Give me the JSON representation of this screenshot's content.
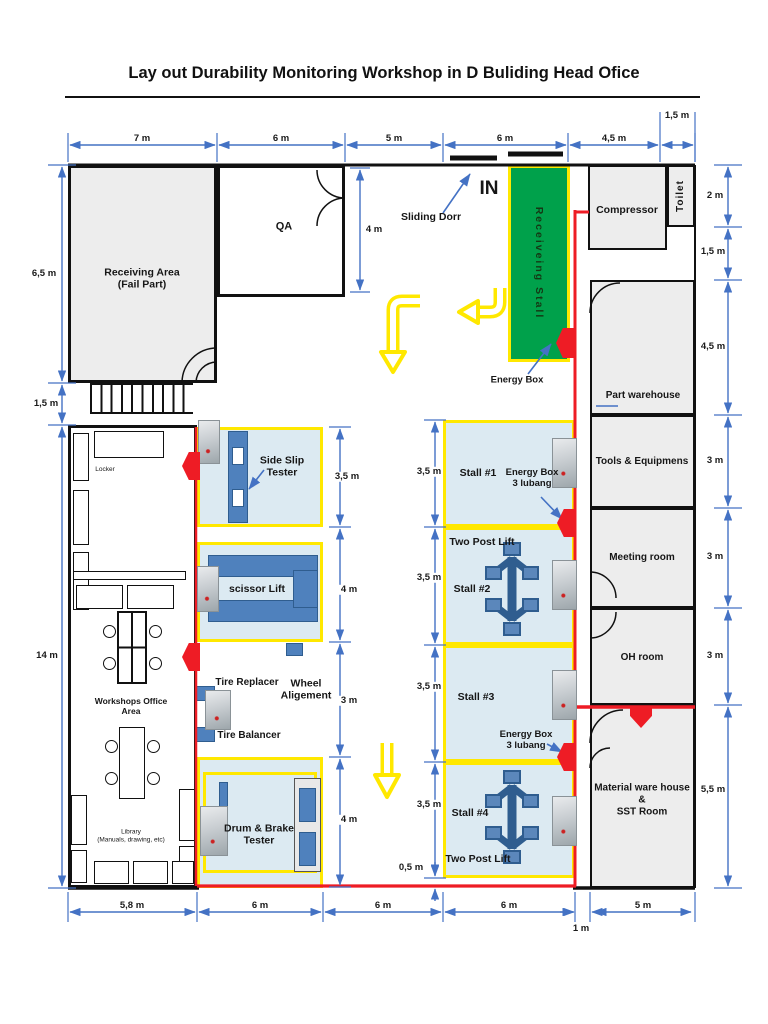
{
  "title": "Lay out Durability Monitoring Workshop in D Buliding Head Ofice",
  "colors": {
    "wall": "#111111",
    "dim-blue": "#4472C4",
    "accent-red": "#EE1C25",
    "accent-yellow": "#FFE800",
    "accent-green": "#00A14B",
    "equip-blue": "#4F81BD",
    "room-fill": "#EDEDED",
    "stall-fill": "#DCEAF2"
  },
  "rooms": {
    "receiving_area": "Receiving Area\n(Fail Part)",
    "qa": "QA",
    "receiving_stall": "Receiveing Stall",
    "compressor": "Compressor",
    "toilet": "Toilet",
    "part_warehouse": "Part warehouse",
    "tools_equipment": "Tools & Equipmens",
    "meeting_room": "Meeting room",
    "oh_room": "OH room",
    "material_sst": "Material ware house\n&\nSST Room"
  },
  "office": {
    "locker": "Locker",
    "workshops_office": "Workshops Office\nArea",
    "library": "Library\n(Manuals, drawing, etc)"
  },
  "equipment": {
    "side_slip_tester": "Side Slip\nTester",
    "scissor_lift": "scissor Lift",
    "tire_replacer": "Tire Replacer",
    "tire_balancer": "Tire Balancer",
    "wheel_alignment": "Wheel\nAligement",
    "drum_brake_tester": "Drum & Brake\nTester"
  },
  "stalls": {
    "stall1": "Stall #1",
    "stall2": "Stall #2",
    "stall3": "Stall #3",
    "stall4": "Stall #4",
    "two_post_lift": "Two Post Lift"
  },
  "annotations": {
    "sliding_door": "Sliding Dorr",
    "entrance": "IN",
    "energy_box": "Energy Box",
    "energy_box_3_lubang": "Energy Box\n3 lubang"
  },
  "dims": {
    "top": [
      "7 m",
      "6 m",
      "5 m",
      "6 m",
      "4,5 m",
      "1,5 m"
    ],
    "left": [
      "6,5 m",
      "1,5 m",
      "14 m"
    ],
    "right": [
      "2 m",
      "1,5 m",
      "4,5 m",
      "3 m",
      "3 m",
      "3 m",
      "5,5 m"
    ],
    "bottom": [
      "5,8 m",
      "6 m",
      "6 m",
      "6 m",
      "1 m",
      "5 m"
    ],
    "equipment_column": [
      "3,5 m",
      "4 m",
      "3 m",
      "4 m"
    ],
    "stall_column": [
      "3,5 m",
      "3,5 m",
      "3,5 m",
      "3,5 m",
      "0,5 m"
    ],
    "qa_depth": "4 m"
  }
}
